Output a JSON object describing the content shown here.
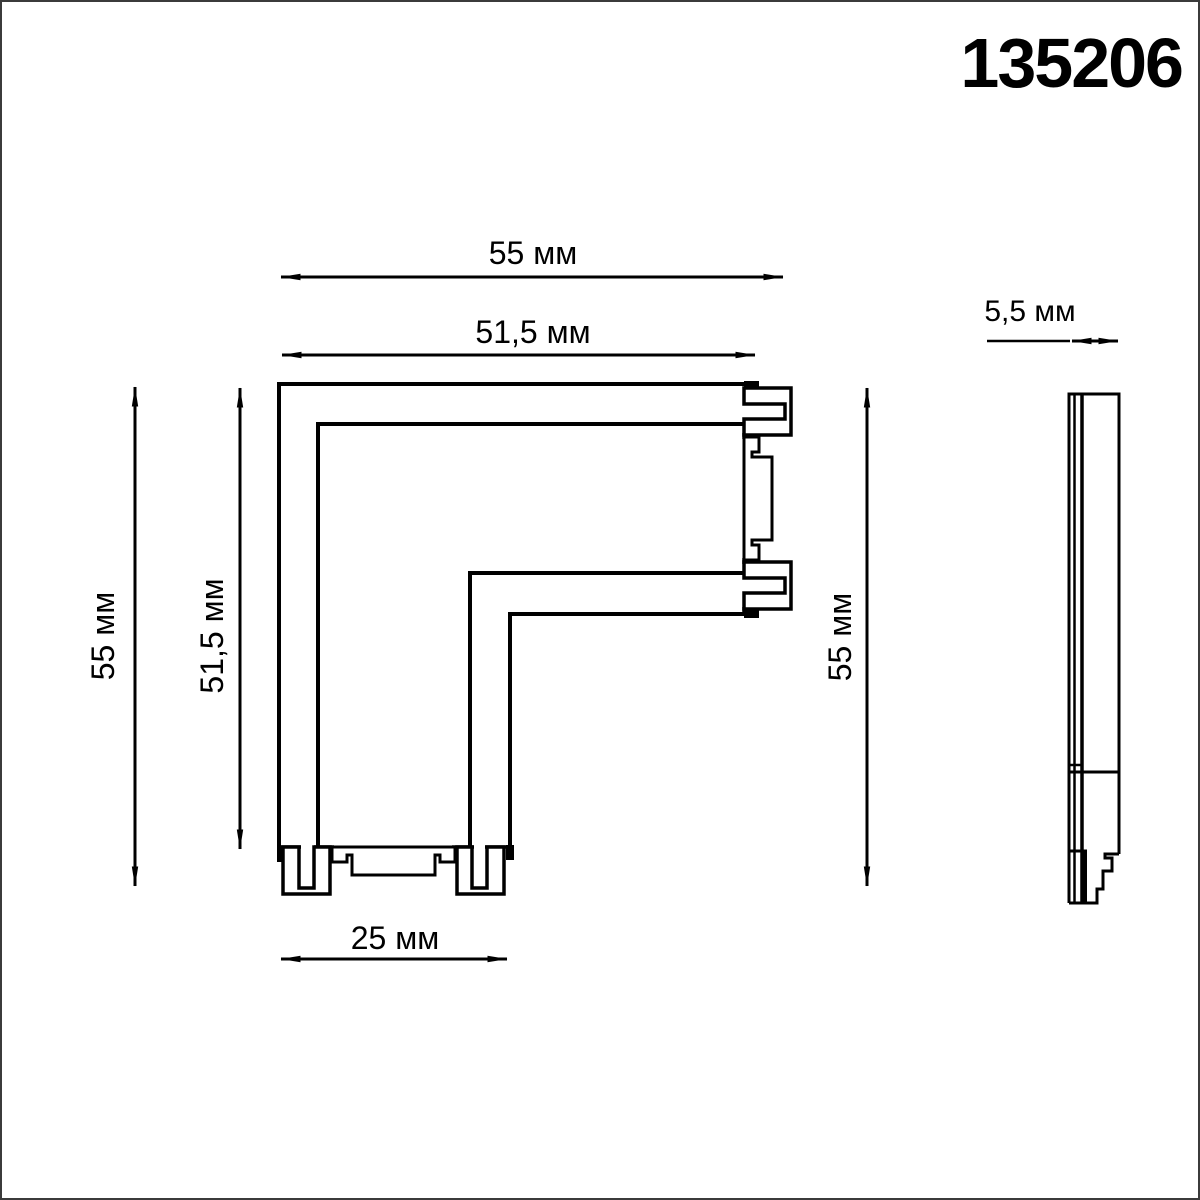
{
  "product_code": "135206",
  "drawing": {
    "front_view": {
      "dim_top_width": "55 мм",
      "dim_inner_width": "51,5 мм",
      "dim_left_height": "55 мм",
      "dim_inner_height": "51,5 мм",
      "dim_right_height": "55 мм",
      "dim_bottom_width": "25 мм"
    },
    "side_view": {
      "dim_thickness": "5,5 мм"
    }
  },
  "colors": {
    "ink": "#000000",
    "background": "#ffffff",
    "frame": "#3b3b3b"
  }
}
